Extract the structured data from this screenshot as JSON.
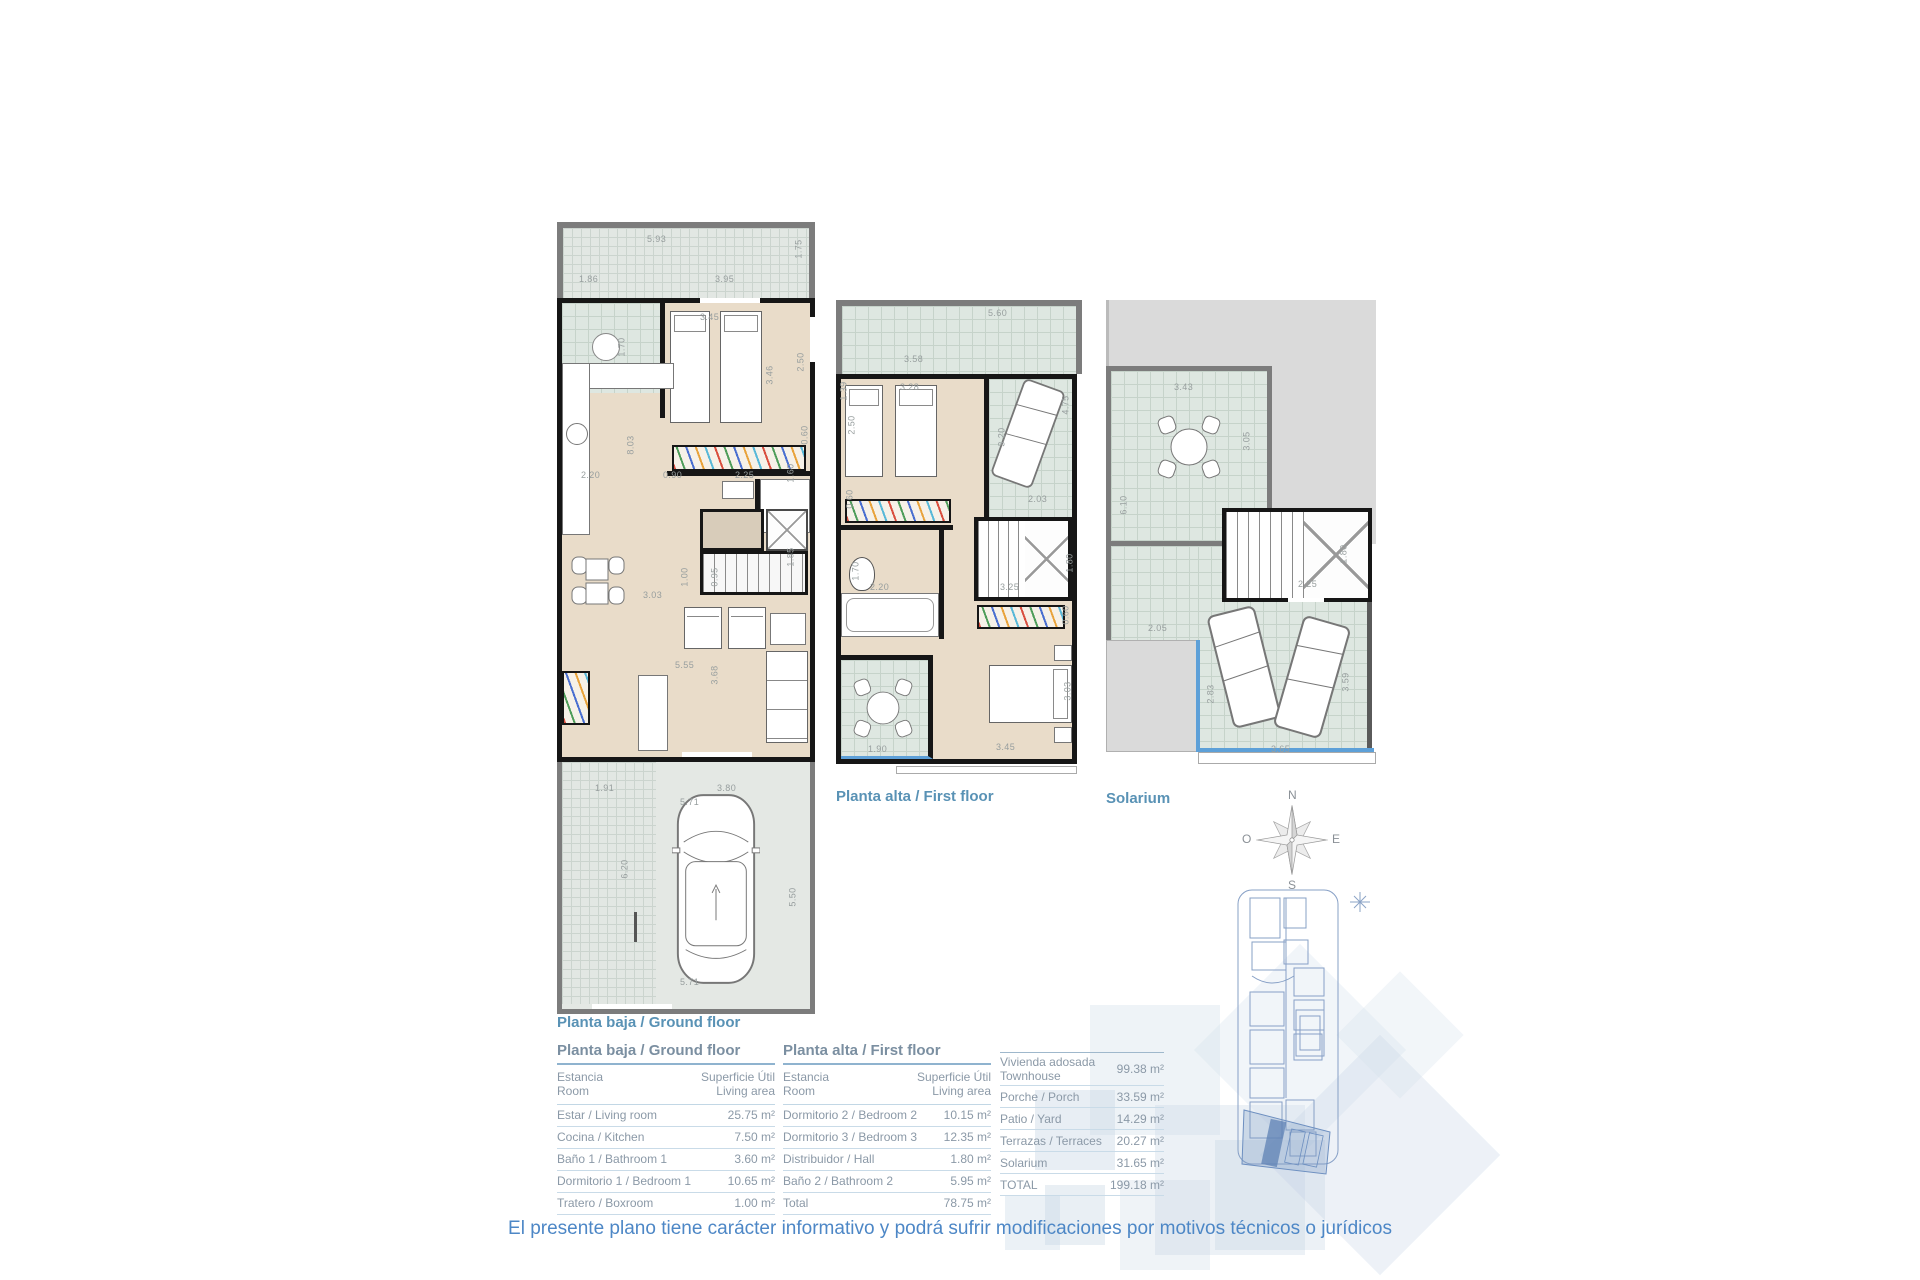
{
  "captions": {
    "ground": "Planta baja / Ground floor",
    "first": "Planta alta / First floor",
    "solarium": "Solarium"
  },
  "compass": {
    "n": "N",
    "o": "O",
    "e": "E",
    "s": "S"
  },
  "plans": {
    "ground": {
      "dims": [
        "5.93",
        "1.75",
        "1.86",
        "3.95",
        "3.45",
        "2.50",
        "3.46",
        "1.70",
        "2.20",
        "0.90",
        "2.25",
        "1.60",
        "0.60",
        "8.03",
        "3.03",
        "1.00",
        "0.95",
        "1.85",
        "5.55",
        "3.68",
        "1.91",
        "3.80",
        "5.71",
        "6.20",
        "5.50",
        "5.71"
      ]
    },
    "first": {
      "dims": [
        "5.60",
        "1.39",
        "3.58",
        "3.28",
        "2.50",
        "4.75",
        "3.20",
        "0.60",
        "2.03",
        "2.20",
        "1.70",
        "3.25",
        "1.80",
        "0.60",
        "3.03",
        "3.45",
        "1.90"
      ]
    },
    "solarium": {
      "dims": [
        "3.43",
        "3.05",
        "6.10",
        "2.25",
        "1.80",
        "2.05",
        "2.83",
        "3.65",
        "3.59"
      ]
    }
  },
  "tables": [
    {
      "title": "Planta baja / Ground floor",
      "header": {
        "room_es": "Estancia",
        "room_en": "Room",
        "area_es": "Superficie Útil",
        "area_en": "Living area"
      },
      "rows": [
        {
          "label": "Estar / Living room",
          "value": "25.75 m²"
        },
        {
          "label": "Cocina / Kitchen",
          "value": "7.50 m²"
        },
        {
          "label": "Baño 1 / Bathroom 1",
          "value": "3.60 m²"
        },
        {
          "label": "Dormitorio 1 / Bedroom 1",
          "value": "10.65 m²"
        },
        {
          "label": "Tratero / Boxroom",
          "value": "1.00 m²"
        }
      ]
    },
    {
      "title": "Planta alta / First floor",
      "header": {
        "room_es": "Estancia",
        "room_en": "Room",
        "area_es": "Superficie Útil",
        "area_en": "Living area"
      },
      "rows": [
        {
          "label": "Dormitorio 2 / Bedroom 2",
          "value": "10.15 m²"
        },
        {
          "label": "Dormitorio 3 / Bedroom 3",
          "value": "12.35 m²"
        },
        {
          "label": "Distribuidor / Hall",
          "value": "1.80 m²"
        },
        {
          "label": "Baño 2 / Bathroom 2",
          "value": "5.95 m²"
        },
        {
          "label": "Total",
          "value": "78.75 m²"
        }
      ]
    },
    {
      "rows": [
        {
          "label": "Vivienda adosada",
          "label2": "Townhouse",
          "value": "99.38 m²"
        },
        {
          "label": "Porche / Porch",
          "value": "33.59 m²"
        },
        {
          "label": "Patio / Yard",
          "value": "14.29 m²"
        },
        {
          "label": "Terrazas / Terraces",
          "value": "20.27 m²"
        },
        {
          "label": "Solarium",
          "value": "31.65 m²"
        },
        {
          "label": "TOTAL",
          "value": "199.18 m²"
        }
      ]
    }
  ],
  "disclaimer": "El presente plano tiene carácter informativo y podrá sufrir modificaciones por motivos técnicos o jurídicos",
  "colors": {
    "accent_blue": "#5992b5",
    "disclaimer_blue": "#4d87c6",
    "table_text": "#8b99a7",
    "wall_black": "#161616",
    "wall_gray": "#7c7c7c",
    "floor_beige": "#e9dcc9",
    "tile_green": "#dee7e1",
    "railing_blue": "#5da0d8"
  }
}
